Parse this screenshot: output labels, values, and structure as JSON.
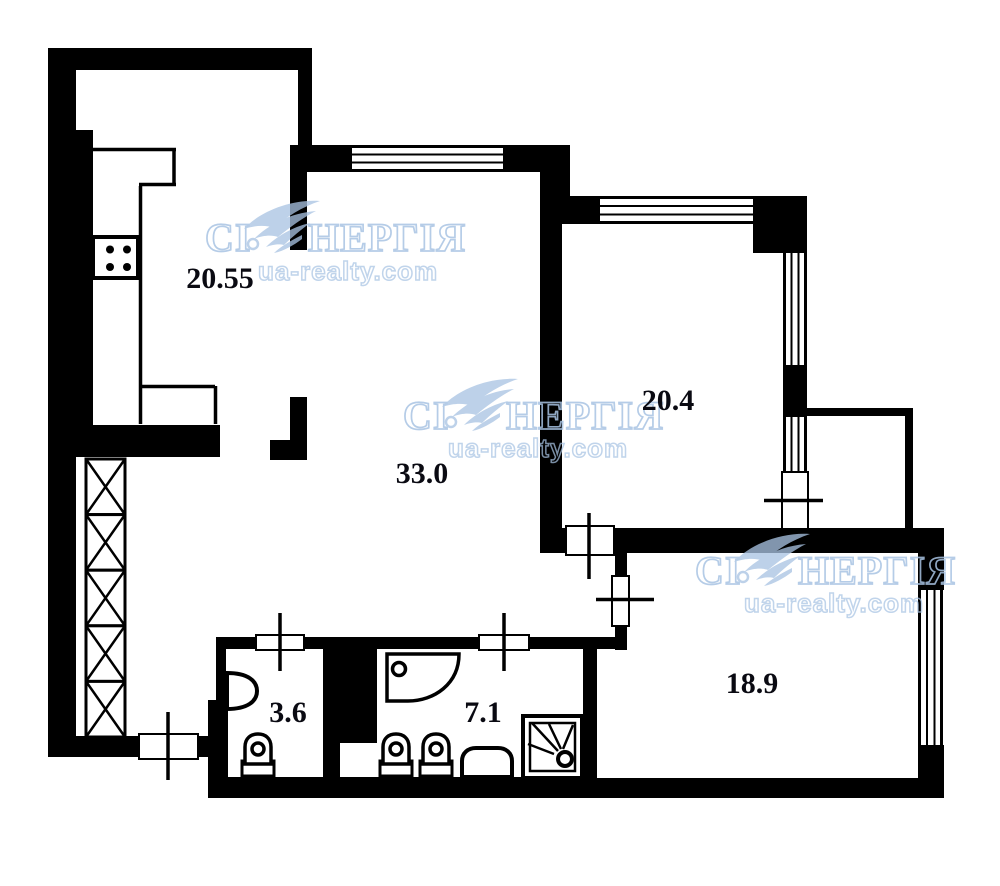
{
  "plan": {
    "background": "#ffffff",
    "wall_color": "#000000"
  },
  "watermark": {
    "brand_prefix": "СІ",
    "brand_suffix": "НЕРГІЯ",
    "url": "ua-realty.com",
    "color": "#a9c4e3"
  },
  "rooms": {
    "kitchen": {
      "area": "20.55"
    },
    "living_room": {
      "area": "33.0"
    },
    "bedroom": {
      "area": "20.4"
    },
    "second_bedroom": {
      "area": "18.9"
    },
    "wc": {
      "area": "3.6"
    },
    "bathroom": {
      "area": "7.1"
    }
  }
}
